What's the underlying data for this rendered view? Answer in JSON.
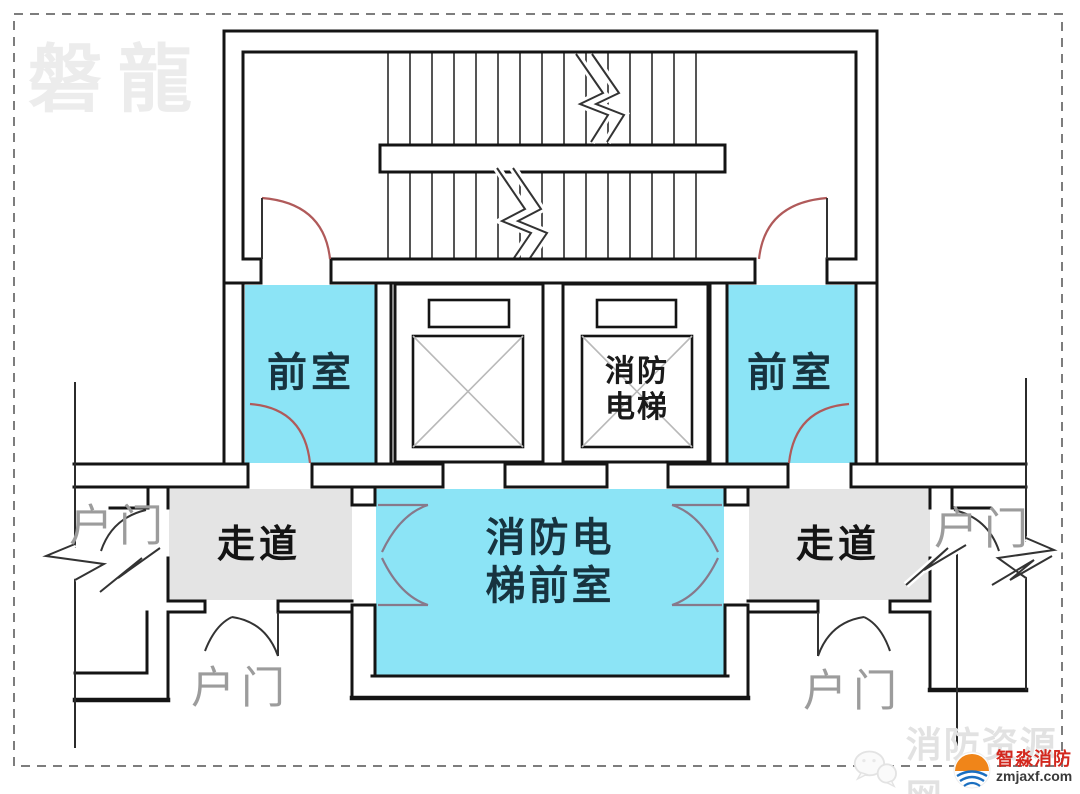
{
  "watermark_top_left": {
    "text": "磐龍"
  },
  "plan": {
    "rooms": {
      "front_room_left": {
        "label": "前室"
      },
      "front_room_right": {
        "label": "前室"
      },
      "fire_elevator": {
        "label_line1": "消防",
        "label_line2": "电梯"
      },
      "fire_elevator_lobby": {
        "label_line1": "消防电",
        "label_line2": "梯前室"
      },
      "corridor_left": {
        "label": "走道"
      },
      "corridor_right": {
        "label": "走道"
      }
    },
    "door_labels": {
      "left": "户门",
      "bottom_left": "户门",
      "right": "户门",
      "bottom_right": "户门"
    }
  },
  "watermark_bottom_right": {
    "icon": "wechat-bubbles-icon",
    "text": "消防资源网"
  },
  "brand": {
    "name": "智淼消防",
    "domain": "zmjaxf.com"
  },
  "colors": {
    "room_fill": "#8CE4F6",
    "corridor_fill": "#E4E4E4",
    "wall": "#141414",
    "stair_door_arc": "#B05A5A",
    "lobby_door_arc": "#87798B",
    "label_dark": "#17333F",
    "door_label_gray": "#9C9C9C",
    "brand_red": "#D3281E",
    "brand_orange": "#F08519",
    "brand_blue": "#1B6FC0"
  }
}
